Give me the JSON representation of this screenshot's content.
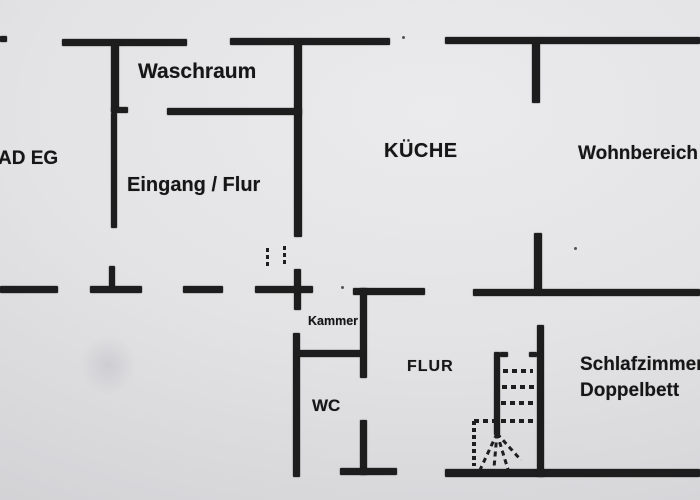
{
  "rooms": {
    "bad_eg": "AD EG",
    "waschraum": "Waschraum",
    "eingang_flur": "Eingang / Flur",
    "kueche": "KÜCHE",
    "wohnbereich": "Wohnbereich",
    "kammer": "Kammer",
    "wc": "WC",
    "flur": "FLUR",
    "schlafzimmer": "Schlafzimmer",
    "doppelbett": "Doppelbett"
  },
  "colors": {
    "wall": "#1d1d1d",
    "paper_light": "#ebebed",
    "paper_dark": "#cdcdd0",
    "text": "#161616"
  }
}
